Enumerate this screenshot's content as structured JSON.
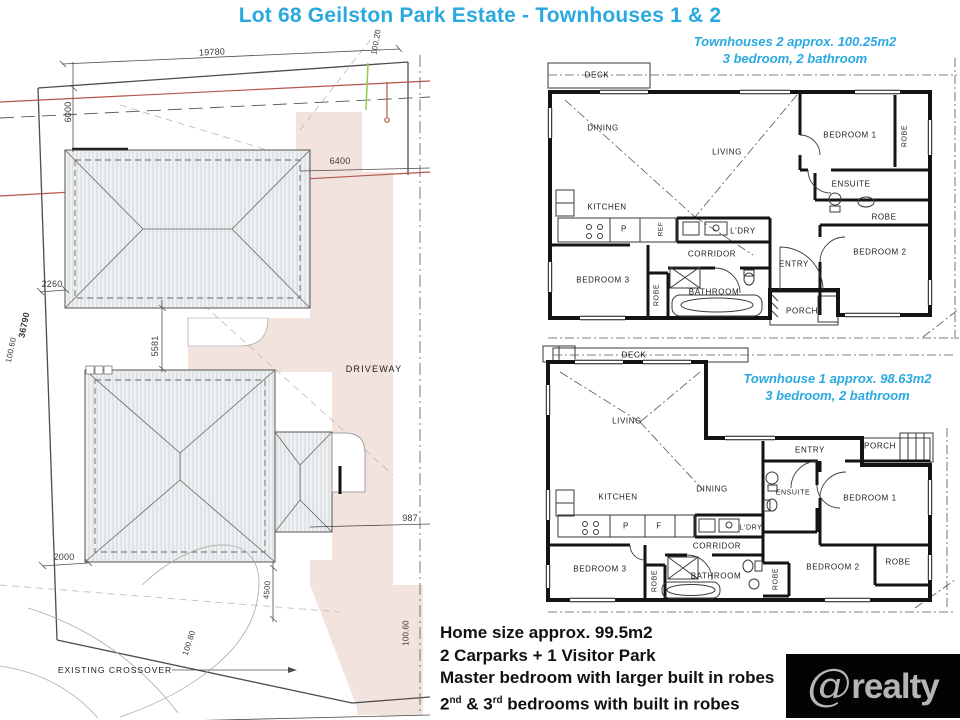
{
  "title": "Lot 68 Geilston Park Estate  - Townhouses 1 & 2",
  "townhouse2": {
    "caption_line1": "Townhouses 2 approx. 100.25m2",
    "caption_line2": "3 bedroom, 2 bathroom",
    "rooms": {
      "deck": "DECK",
      "dining": "DINING",
      "living": "LIVING",
      "kitchen": "KITCHEN",
      "pantry": "P",
      "ref": "REF",
      "ldry": "L'DRY",
      "corridor": "CORRIDOR",
      "bedroom3": "BEDROOM 3",
      "robe3": "ROBE",
      "bathroom": "BATHROOM",
      "bedroom1": "BEDROOM 1",
      "robe1": "ROBE",
      "ensuite": "ENSUITE",
      "robe2": "ROBE",
      "bedroom2": "BEDROOM 2",
      "entry": "ENTRY",
      "porch": "PORCH"
    }
  },
  "townhouse1": {
    "caption_line1": "Townhouse 1 approx. 98.63m2",
    "caption_line2": "3 bedroom, 2 bathroom",
    "rooms": {
      "deck": "DECK",
      "living": "LIVING",
      "dining": "DINING",
      "kitchen": "KITCHEN",
      "pantry": "P",
      "fridge": "F",
      "ldry": "L'DRY",
      "corridor": "CORRIDOR",
      "bedroom3": "BEDROOM 3",
      "robe3": "ROBE",
      "bathroom": "BATHROOM",
      "entry": "ENTRY",
      "porch": "PORCH",
      "ensuite": "ENSUITE",
      "bedroom1": "BEDROOM 1",
      "robe_b2": "ROBE",
      "bedroom2": "BEDROOM 2",
      "robe_b1": "ROBE"
    }
  },
  "site_plan": {
    "labels": {
      "driveway": "DRIVEWAY",
      "existing_crossover": "EXISTING CROSSOVER"
    },
    "dimensions": {
      "d19780": "19780",
      "d100_20": "100.20",
      "d6000": "6000",
      "d6400": "6400",
      "d2260": "2260",
      "d36790": "36790",
      "d100_60a": "100.60",
      "d5581": "5581",
      "d2000": "2000",
      "d4500": "4500",
      "d100_80": "100.80",
      "d100_60b": "100.60",
      "d987": "987"
    }
  },
  "footer": {
    "line1": "Home size approx. 99.5m2",
    "line2": "2 Carparks + 1 Visitor Park",
    "line3": "Master bedroom with larger built in robes",
    "line4_parts": {
      "a": "2",
      "a_sup": "nd",
      "b": " & 3",
      "b_sup": "rd",
      "c": " bedrooms with built in robes"
    }
  },
  "logo": {
    "at": "@",
    "name": "realty"
  },
  "colors": {
    "accent": "#2aa9e0",
    "driveway_fill": "#f2e3de",
    "boundary_red": "#b5564c",
    "marker_green": "#93c94e",
    "logo_bg": "#030303",
    "logo_fg": "#b5b5b5"
  }
}
